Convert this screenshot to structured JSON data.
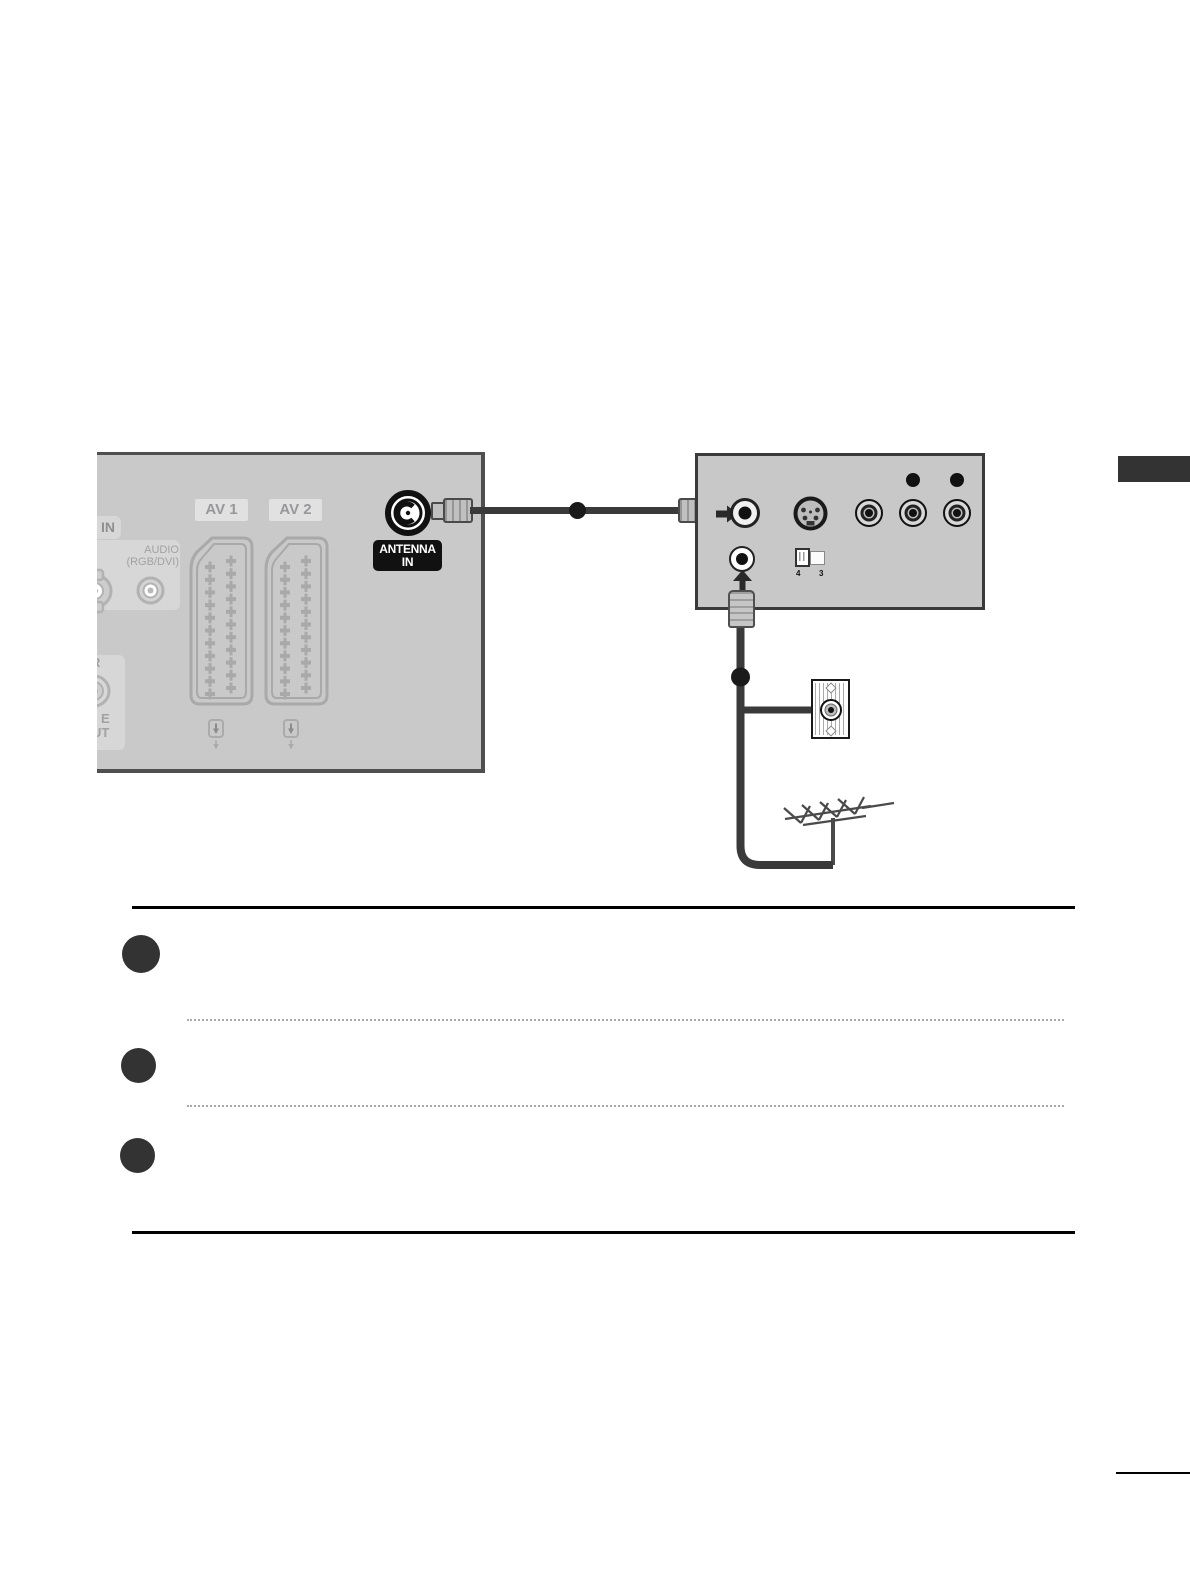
{
  "page": {
    "background": "#ffffff"
  },
  "colors": {
    "panel_gray": "#c9c9c9",
    "cable": "#3a3a3a",
    "side_tab": "#333333",
    "step_marker": "#333333",
    "antenna_label_bg": "#111111"
  },
  "tv_panel": {
    "rgb_in_fragment": "B IN",
    "audio_label_line1": "AUDIO",
    "audio_label_line2": "(RGB/DVI)",
    "left_fragment_r": "R",
    "left_fragment_e": "E",
    "left_fragment_ut": "UT",
    "av1_label": "AV 1",
    "av2_label": "AV 2",
    "antenna_label_line1": "ANTENNA",
    "antenna_label_line2": "IN"
  },
  "vcr_panel": {
    "switch_label_left": "4",
    "switch_label_right": "3"
  },
  "icons": {
    "antenna_in_jack": "coax-socket",
    "scart": "scart-connector",
    "s_video": "s-video-port",
    "rca": "rca-jack",
    "aerial": "tv-aerial",
    "wall_socket": "antenna-wall-outlet"
  },
  "steps": {
    "count": 3
  }
}
